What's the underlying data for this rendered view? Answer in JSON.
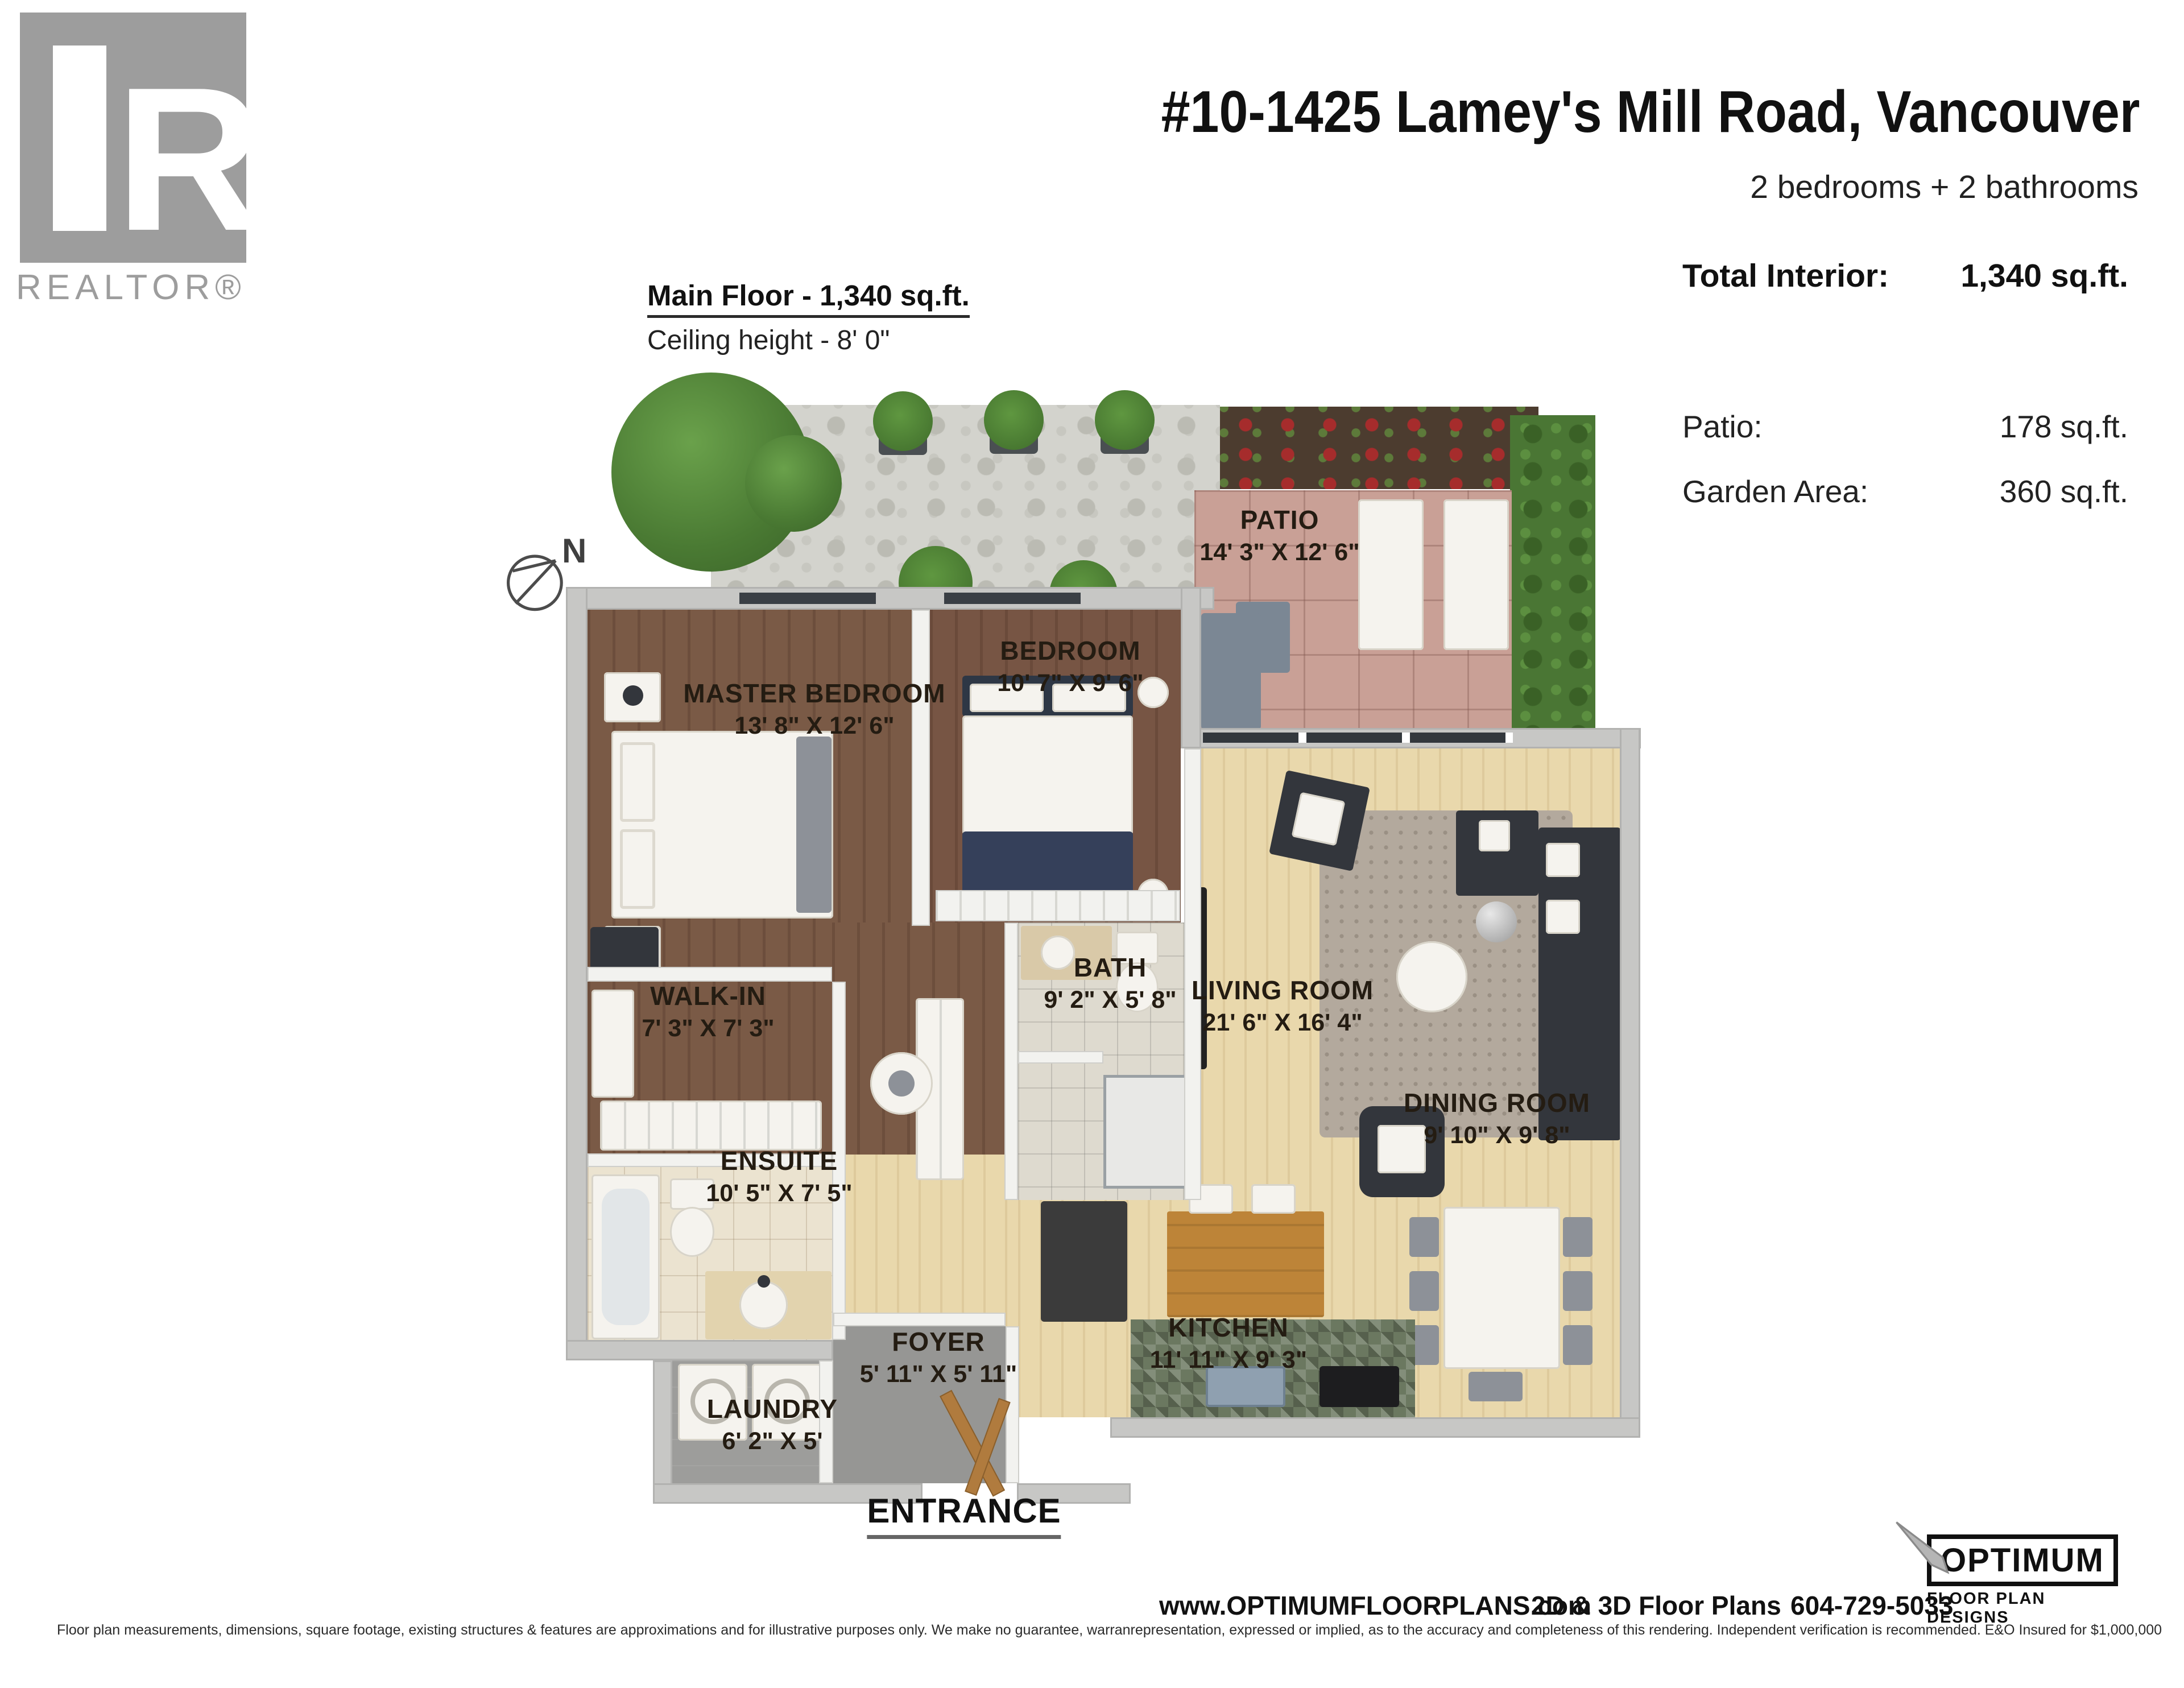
{
  "branding": {
    "realtor_logo_letter": "R",
    "realtor_logo_text": "REALTOR®",
    "optimum_logo_line1": "OPTIMUM",
    "optimum_logo_line2": "FLOOR PLAN DESIGNS"
  },
  "header": {
    "title": "#10-1425 Lamey's Mill Road, Vancouver",
    "subtitle": "2 bedrooms + 2 bathrooms"
  },
  "stats": {
    "total_label": "Total Interior:",
    "total_value": "1,340 sq.ft.",
    "rows": [
      {
        "label": "Patio:",
        "value": "178 sq.ft."
      },
      {
        "label": "Garden Area:",
        "value": "360 sq.ft."
      }
    ]
  },
  "floor_info": {
    "title": "Main Floor - 1,340 sq.ft.",
    "ceiling": "Ceiling height - 8' 0\""
  },
  "compass": {
    "label": "N"
  },
  "rooms": [
    {
      "id": "patio",
      "name": "PATIO",
      "dims": "14' 3\" X 12' 6\""
    },
    {
      "id": "bedroom",
      "name": "BEDROOM",
      "dims": "10' 7\" X 9' 6\""
    },
    {
      "id": "master",
      "name": "MASTER BEDROOM",
      "dims": "13' 8\" X 12' 6\""
    },
    {
      "id": "walkin",
      "name": "WALK-IN",
      "dims": "7' 3\" X 7' 3\""
    },
    {
      "id": "bath",
      "name": "BATH",
      "dims": "9' 2\" X 5' 8\""
    },
    {
      "id": "living",
      "name": "LIVING ROOM",
      "dims": "21' 6\" X 16' 4\""
    },
    {
      "id": "dining",
      "name": "DINING ROOM",
      "dims": "9' 10\" X 9' 8\""
    },
    {
      "id": "ensuite",
      "name": "ENSUITE",
      "dims": "10' 5\" X 7' 5\""
    },
    {
      "id": "foyer",
      "name": "FOYER",
      "dims": "5' 11\" X 5' 11\""
    },
    {
      "id": "laundry",
      "name": "LAUNDRY",
      "dims": "6' 2\" X 5'"
    },
    {
      "id": "kitchen",
      "name": "KITCHEN",
      "dims": "11' 11\" X 9' 3\""
    }
  ],
  "entrance_label": "ENTRANCE",
  "footer": {
    "website": "www.OPTIMUMFLOORPLANS.com",
    "services": "2D & 3D Floor Plans",
    "phone": "604-729-5033",
    "disclaimer": "Floor plan measurements, dimensions, square footage, existing structures & features are approximations and for illustrative purposes only. We make no guarantee, warranrepresentation, expressed or implied, as to the accuracy and completeness of this rendering. Independent verification is recommended. E&O Insured for $1,000,000"
  },
  "colors": {
    "realtor_gray": "#9d9d9d",
    "wall_gray": "#c7c7c5",
    "wood_dark": "#7a5a46",
    "wood_light": "#e9d8ac",
    "patio_pink": "#c9a096",
    "hedge_green": "#4a7634",
    "label_ink": "#241c12"
  }
}
